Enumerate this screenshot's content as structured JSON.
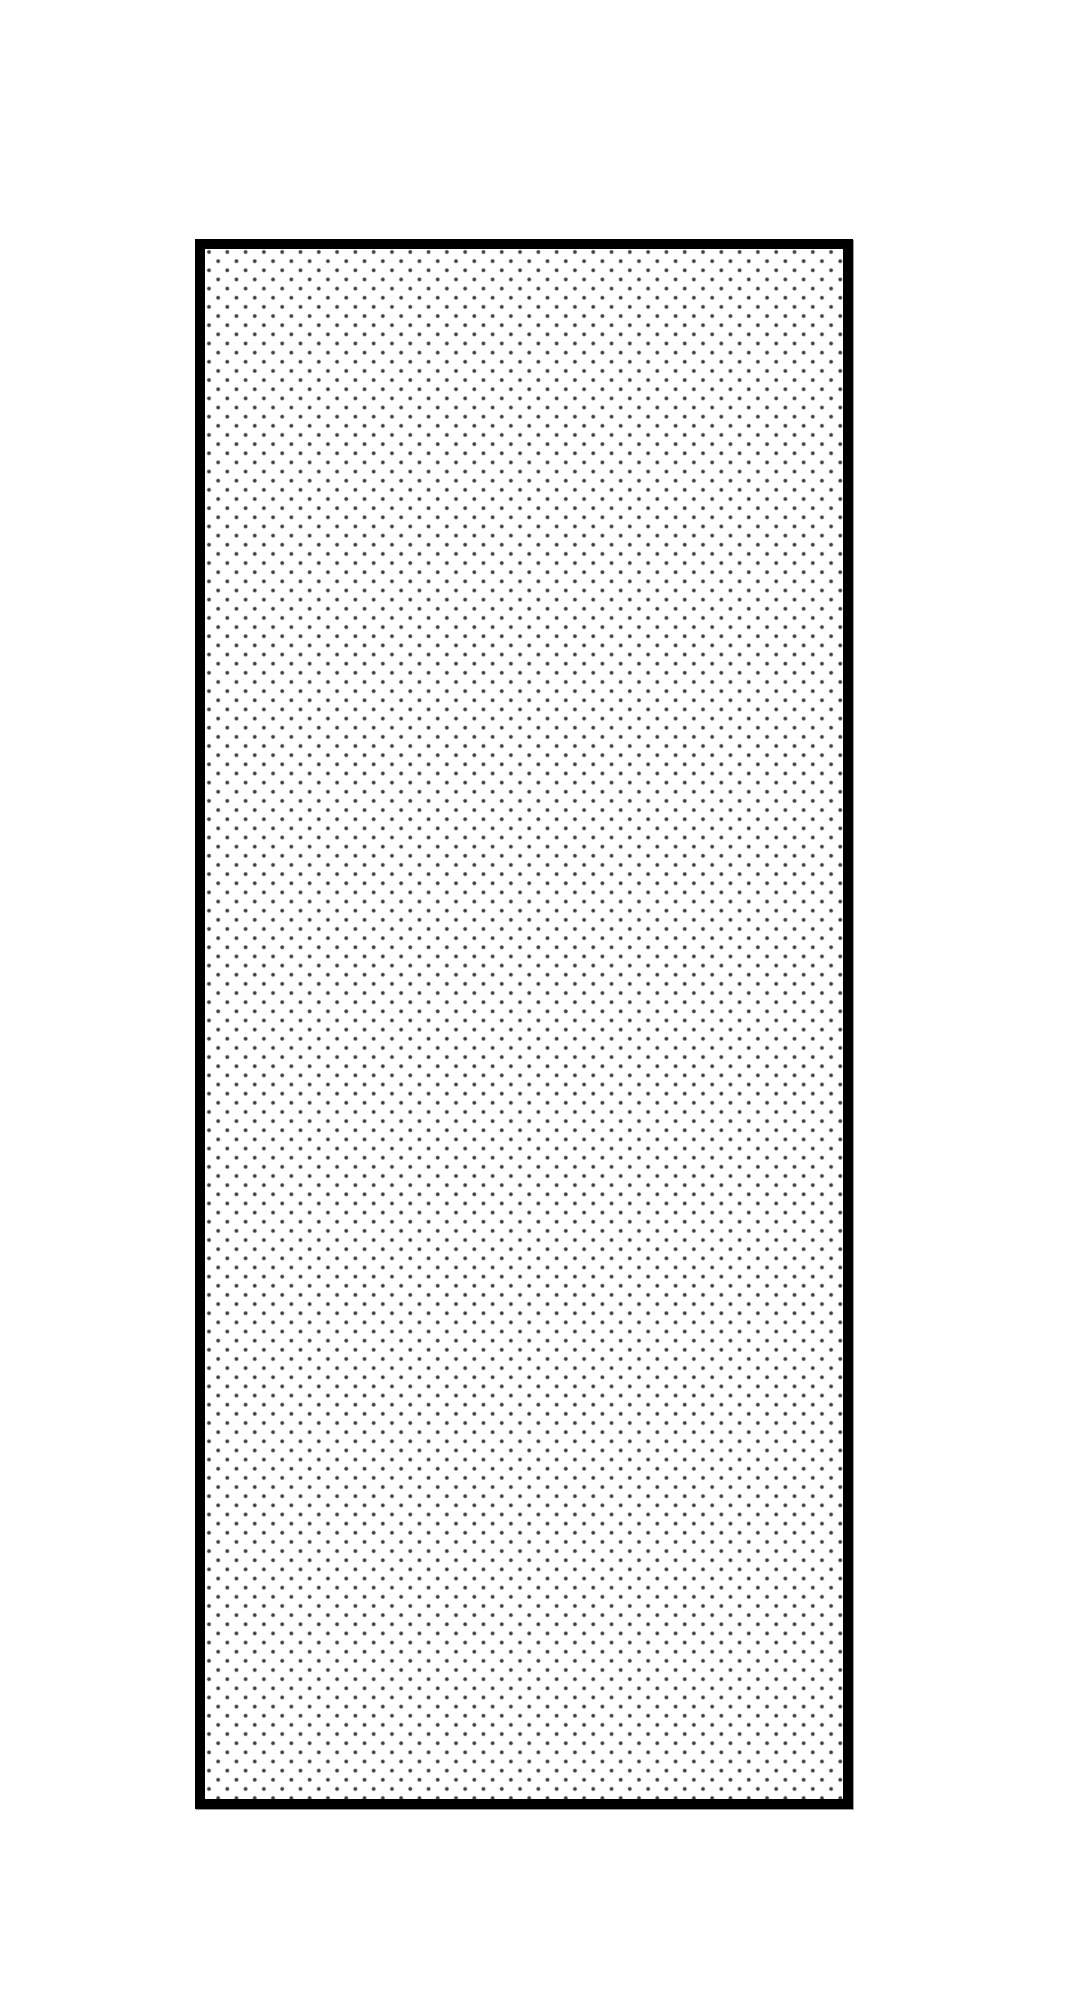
{
  "canvas": {
    "background": "#ffffff"
  },
  "figure": {
    "name": "dotted-hatch-rectangle",
    "shape": "rectangle",
    "pattern": "staggered-dot-grid",
    "border_color": "#000000",
    "fill_color": "#fefefe",
    "dot_color": "#404040"
  },
  "theme": {
    "page-bg": "#ffffff",
    "rect-border-color": "#000000",
    "rect-border-width": "10px",
    "rect-fill": "#fefefe",
    "dot-color": "#404040",
    "dot-spacing": "18.3px",
    "dot-offset": "9.15px",
    "dot-radius": "1.35px",
    "dot-halo": "2.5px"
  }
}
